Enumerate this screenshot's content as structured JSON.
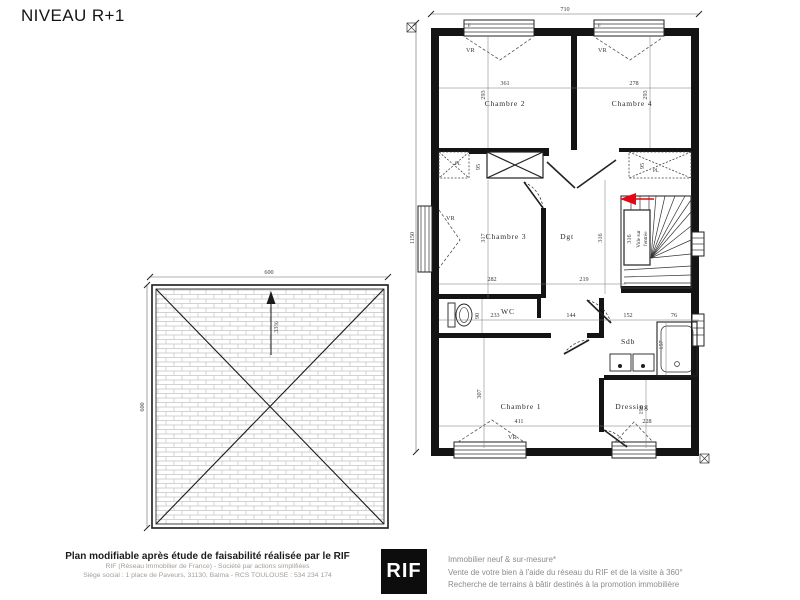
{
  "title": "NIVEAU R+1",
  "colors": {
    "wall": "#141414",
    "dimension_text": "#3a3a3a",
    "arrow_red": "#e30613",
    "roof_hatch": "#c4c4c4",
    "footer_grey": "#a39e99"
  },
  "floor_plan": {
    "width_dim": "710",
    "height_dim": "1150",
    "rooms": {
      "chambre2": {
        "label": "Chambre 2",
        "w": "361",
        "h": "293"
      },
      "chambre4": {
        "label": "Chambre 4",
        "w": "278",
        "h": "293"
      },
      "chambre3": {
        "label": "Chambre 3",
        "w": "282",
        "h": "317"
      },
      "degagement": {
        "label": "Dgt",
        "w": "219",
        "h": "316"
      },
      "wc": {
        "label": "WC",
        "w": "233",
        "h": "90"
      },
      "sdb": {
        "label": "Sdb",
        "w": "152",
        "h": "157"
      },
      "chambre1": {
        "label": "Chambre 1",
        "w": "411",
        "h": "307"
      },
      "dressing": {
        "label": "Dressing",
        "w": "228",
        "h": "196"
      }
    },
    "stairwell": {
      "line1": "Vide sur",
      "line2": "l'entrée",
      "dim": "316"
    },
    "extra_dims": {
      "hall_w": "144",
      "bath_w": "76",
      "closet_left": "95",
      "closet_right": "95"
    },
    "labels": {
      "vr": "VR",
      "pl": "PL",
      "f": "F"
    }
  },
  "roof_plan": {
    "width_dim": "600",
    "height_dim": "600",
    "slope": "33%"
  },
  "footer": {
    "left_bold": "Plan modifiable après étude de faisabilité réalisée par le RIF",
    "left_line2": "RIF (Réseau Immobilier de France) - Société par actions simplifiées",
    "left_line3": "Siège social : 1 place de Paveurs, 31130, Balma - RCS TOULOUSE : 534 234 174",
    "logo": "RIF",
    "right_line1": "Immobilier neuf & sur-mesure*",
    "right_line2": "Vente de votre bien à l'aide du réseau du RIF et de la visite à 360°",
    "right_line3": "Recherche de terrains à bâtir destinés à la promotion immobilière"
  }
}
